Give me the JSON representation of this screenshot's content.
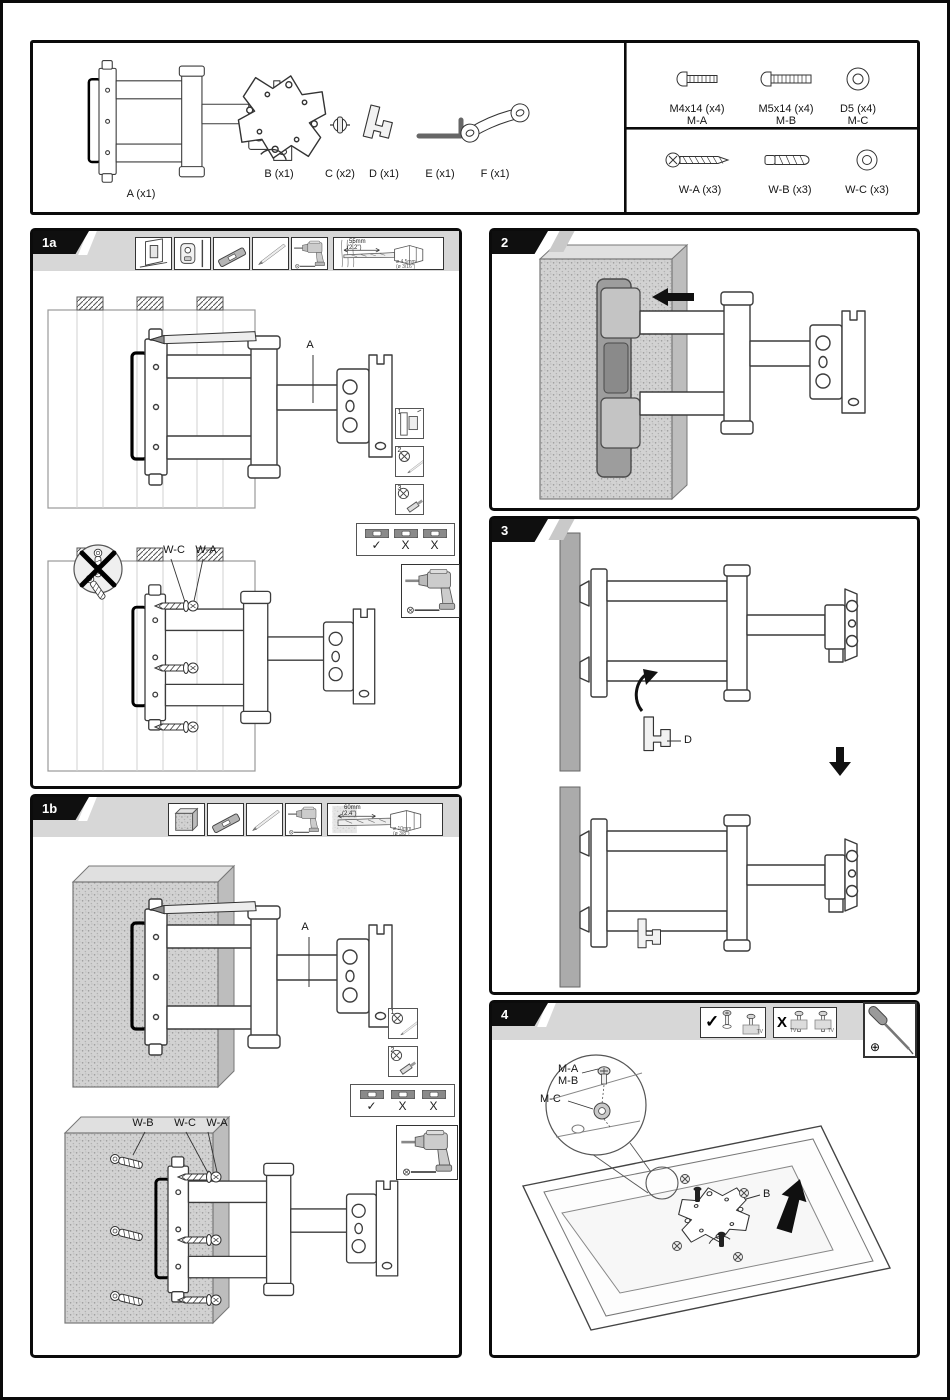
{
  "colors": {
    "ink": "#0b0b0b",
    "strip_gray": "#d7d7d7",
    "concrete_gray": "#cccccc",
    "plate_gray": "#9d9d9d"
  },
  "parts_panel": {
    "parts": [
      {
        "name": "articulating-arm",
        "label": "A (x1)"
      },
      {
        "name": "vesa-plate",
        "label": "B (x1)"
      },
      {
        "name": "spacer",
        "label": "C (x2)"
      },
      {
        "name": "cable-clip",
        "label": "D (x1)"
      },
      {
        "name": "allen-key",
        "label": "E (x1)"
      },
      {
        "name": "wrench",
        "label": "F (x1)"
      }
    ],
    "hardware": {
      "row1": [
        {
          "label": "M4x14 (x4)",
          "sub": "M-A"
        },
        {
          "label": "M5x14 (x4)",
          "sub": "M-B"
        },
        {
          "label": "D5 (x4)",
          "sub": "M-C"
        }
      ],
      "row2": [
        {
          "label": "W-A (x3)",
          "sub": ""
        },
        {
          "label": "W-B (x3)",
          "sub": ""
        },
        {
          "label": "W-C (x3)",
          "sub": ""
        }
      ]
    }
  },
  "section_1a": {
    "tab": "1a",
    "drill_depth": "55mm",
    "drill_depth_in": "(2.2\")",
    "drill_dia": "ø 4.5mm",
    "drill_dia_in": "(ø 3/16\")",
    "callout_a": "A",
    "callout_wc": "W-C",
    "callout_wa": "W-A",
    "steps": [
      "1",
      "2",
      "3"
    ],
    "check_ok": "✓",
    "check_no": "X"
  },
  "section_1b": {
    "tab": "1b",
    "drill_depth": "60mm",
    "drill_depth_in": "(2.4\")",
    "drill_dia": "ø 10mm",
    "drill_dia_in": "(ø 3/8\")",
    "callout_a": "A",
    "callout_wb": "W-B",
    "callout_wc": "W-C",
    "callout_wa": "W-A",
    "steps": [
      "1",
      "2"
    ],
    "check_ok": "✓",
    "check_no": "X"
  },
  "section_2": {
    "tab": "2"
  },
  "section_3": {
    "tab": "3",
    "callout_d": "D"
  },
  "section_4": {
    "tab": "4",
    "check_ok": "✓",
    "check_no": "X",
    "tv_tag": "TV",
    "callout_ma": "M-A",
    "callout_mb": "M-B",
    "callout_mc": "M-C",
    "callout_b": "B",
    "phillips_symbol": "⊕"
  }
}
